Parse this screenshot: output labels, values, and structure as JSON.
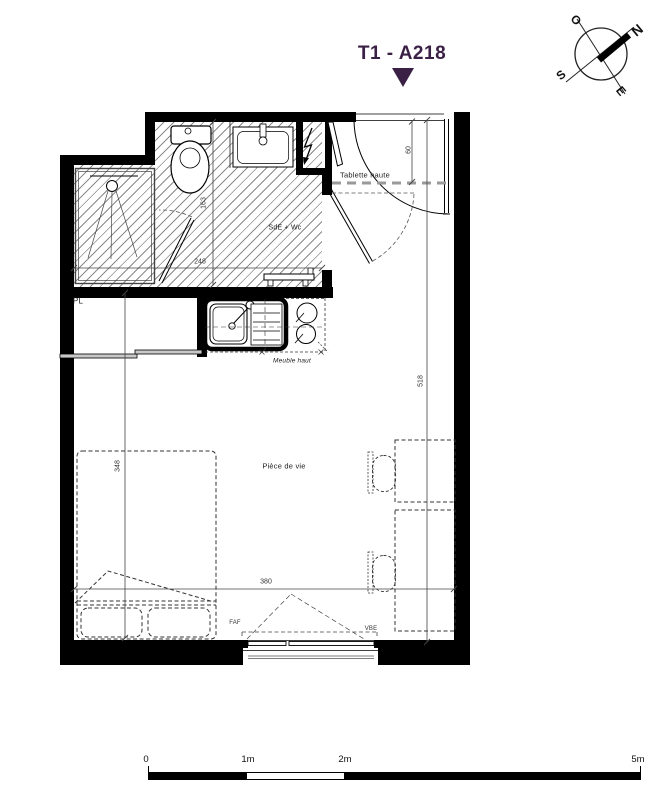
{
  "title": "T1 - A218",
  "compass": {
    "n": "N",
    "s": "S",
    "e": "E",
    "o": "O"
  },
  "rooms": {
    "bathroom": "SdE + Wc",
    "closet": "PL",
    "living": "Pièce de vie"
  },
  "annotations": {
    "tablette": "Tablette haute",
    "meuble_haut": "Meuble haut",
    "faf": "FAF",
    "vbe": "VBE"
  },
  "dimensions": {
    "entry_depth": "60",
    "bathroom_depth": "163",
    "bathroom_width": "248",
    "bed_wall": "348",
    "living_width": "380",
    "living_depth": "518"
  },
  "scale_bar": {
    "t0": "0",
    "t1": "1m",
    "t2": "2m",
    "t5": "5m"
  },
  "colors": {
    "accent_purple": "#3A2045",
    "wall_black": "#000000",
    "hatch_gray": "#8a8a8a",
    "dim_gray": "#444444"
  },
  "icons": {
    "north_arrow": "compass-rose",
    "electric": "lightning-bolt"
  }
}
